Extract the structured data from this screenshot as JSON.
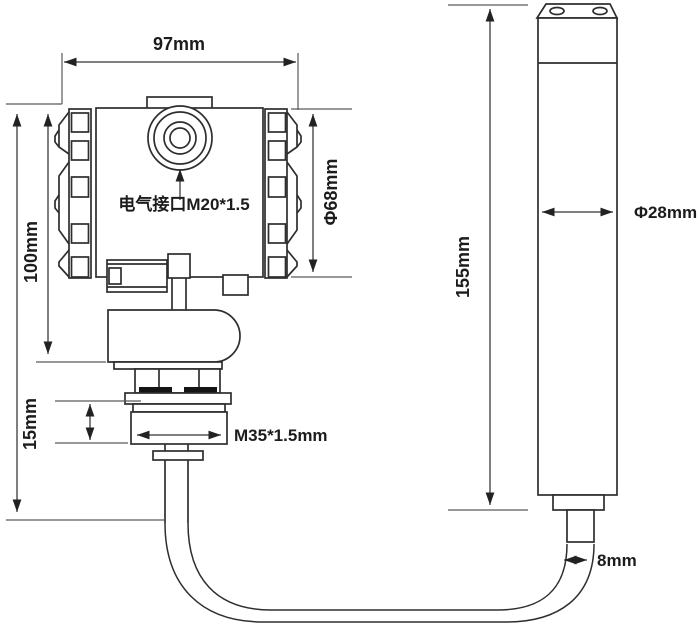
{
  "diagram": {
    "transmitter": {
      "electrical_interface_label": "电气接口M20*1.5",
      "dim_overall_width": "97mm",
      "dim_housing_height": "100mm",
      "dim_housing_diameter": "Φ68mm",
      "dim_thread_section_height": "15mm",
      "dim_process_thread": "M35*1.5mm"
    },
    "probe": {
      "dim_probe_length": "155mm",
      "dim_probe_diameter": "Φ28mm",
      "dim_cable_diameter": "8mm"
    },
    "colors": {
      "outline": "#2e2e2e",
      "dimension_line": "#333333",
      "extension_line": "#5a5a5a",
      "background": "#ffffff"
    }
  }
}
